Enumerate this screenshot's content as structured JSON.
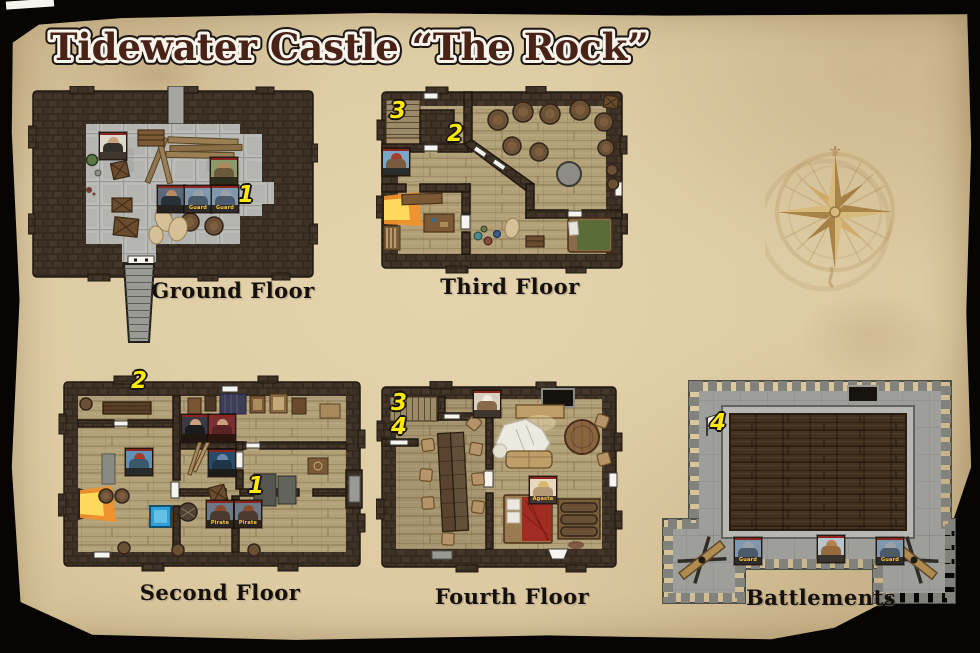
{
  "title": "Tidewater Castle “The Rock”",
  "floors": {
    "ground": {
      "label": "Ground Floor",
      "badges": [
        "1"
      ]
    },
    "third": {
      "label": "Third Floor",
      "badges": [
        "3",
        "2"
      ]
    },
    "second": {
      "label": "Second Floor",
      "badges": [
        "2",
        "1"
      ]
    },
    "fourth": {
      "label": "Fourth Floor",
      "badges": [
        "3",
        "4"
      ]
    },
    "battlements": {
      "label": "Battlements",
      "badges": [
        "4"
      ]
    }
  },
  "tokens": {
    "ground": [
      {
        "name": "robed-man",
        "label": ""
      },
      {
        "name": "noble",
        "label": ""
      },
      {
        "name": "guard-1",
        "label": "Guard"
      },
      {
        "name": "guard-2",
        "label": "Guard"
      },
      {
        "name": "beastman",
        "label": ""
      }
    ],
    "third": [
      {
        "name": "red-haired-woman",
        "label": ""
      }
    ],
    "second": [
      {
        "name": "dark-haired-woman",
        "label": ""
      },
      {
        "name": "red-hatted-woman",
        "label": ""
      },
      {
        "name": "red-haired-woman",
        "label": ""
      },
      {
        "name": "blue-skinned-man",
        "label": ""
      },
      {
        "name": "pirate-1",
        "label": "Pirate"
      },
      {
        "name": "pirate-2",
        "label": "Pirate"
      }
    ],
    "fourth": [
      {
        "name": "turbaned-cook",
        "label": ""
      },
      {
        "name": "agasta",
        "label": "Agasta"
      }
    ],
    "battlements": [
      {
        "name": "guard-1",
        "label": "Guard"
      },
      {
        "name": "strongman",
        "label": ""
      },
      {
        "name": "guard-2",
        "label": "Guard"
      }
    ]
  },
  "compass": {
    "symbol": "compass-rose"
  },
  "colors": {
    "parchment": "#dcc9a2",
    "wall_stone": "#3a2e24",
    "badge_yellow": "#ffe80a",
    "stone_floor": "#b4b5b0",
    "wood_floor": "#b2a077",
    "roof_wood": "#43311f",
    "title_brown": "#4a2318"
  }
}
